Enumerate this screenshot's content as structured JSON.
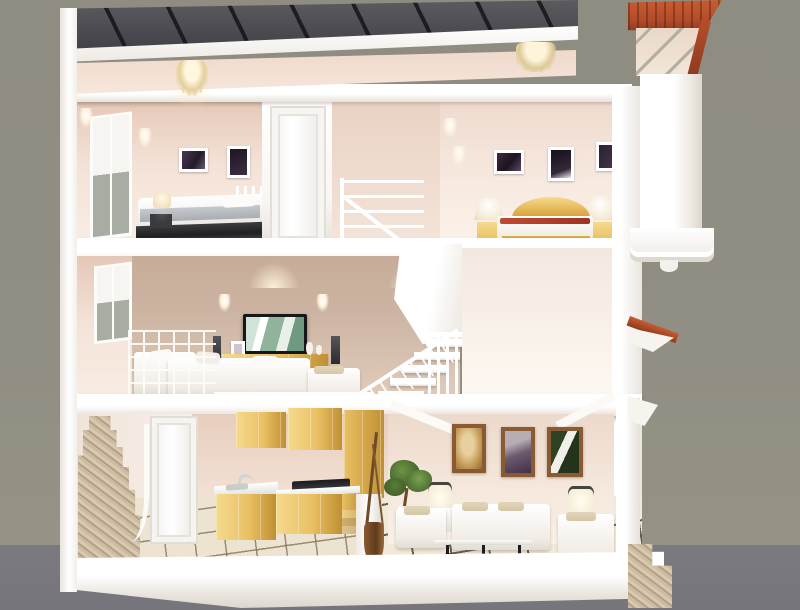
{
  "meta": {
    "description": "3D cutaway cross-section render of a three-story townhouse interior, dollhouse view",
    "style": "photorealistic architectural render, no visible text"
  },
  "palette": {
    "bg": "#918e83",
    "ground": "#76757b",
    "white": "#f8f6f2",
    "whiteDim": "#e6e1da",
    "peach": "#f4e2d7",
    "peachDark": "#e4c7b7",
    "tan": "#ccb3a1",
    "roof": "#4d4d52",
    "roofRib": "#2b2b30",
    "red": "#b44d2a",
    "redDark": "#8e3a1f",
    "wood": "#e9c063",
    "woodL": "#f5da8e",
    "woodD": "#c08f33",
    "frameWood": "#8a5a33",
    "tile": "#ece3d0",
    "stone": "#c3b097",
    "pane": "#a7ada3",
    "dark": "#2a292d",
    "gold": "#dfae49",
    "beige": "#d6c6a8",
    "green": "#5c7d3b",
    "greenDark": "#42602a",
    "brown": "#7a4a28",
    "screen": "#17171b"
  },
  "scene": {
    "backdrop": [
      "studio-gray-wall",
      "dark-gray-ground-plane"
    ],
    "floors": [
      {
        "level": "top",
        "rooms": [
          {
            "name": "master-bedroom-left",
            "items": [
              "corrugated-dark-roof",
              "crystal-chandelier",
              "side-window",
              "wall-sconces-2",
              "framed-photos-2",
              "bedside-lamp",
              "double-bed-white-gray",
              "white-wardrobe-door"
            ]
          },
          {
            "name": "stairwell",
            "items": [
              "white-stair-railing"
            ]
          },
          {
            "name": "bedroom-right",
            "items": [
              "crystal-ceiling-lamp",
              "wall-sconces-2",
              "framed-wedding-photos-3",
              "gold-headboard-bed",
              "red-runner-blanket",
              "nightstands-2",
              "bedside-lamps-2"
            ]
          }
        ]
      },
      {
        "level": "middle",
        "rooms": [
          {
            "name": "family-loft-lounge",
            "items": [
              "side-window",
              "downlights",
              "wall-sconces-2",
              "flat-screen-tv",
              "tv-cabinet-wood",
              "tower-speakers-2",
              "decor-vases",
              "white-corner-sofa",
              "ottoman-chaise",
              "lattice-loft-railing"
            ]
          },
          {
            "name": "stair-hall",
            "items": [
              "white-staircase",
              "baluster-fence",
              "angled-duct-wall"
            ]
          },
          {
            "name": "empty-room-right",
            "items": []
          }
        ]
      },
      {
        "level": "ground",
        "rooms": [
          {
            "name": "kitchen",
            "items": [
              "stone-granite-staircase",
              "curved-white-railing",
              "white-door",
              "upper-cabinets-wood",
              "corner-tall-cabinet",
              "sink-counter-white",
              "faucet",
              "black-cooktop",
              "base-cabinets-wood",
              "drawer-unit",
              "tiled-floor-fine-grid",
              "partition-pillar",
              "floor-vase-with-branches"
            ]
          },
          {
            "name": "living-room",
            "items": [
              "ceiling-beams-white",
              "framed-paintings-3",
              "table-lamp",
              "floor-lamp",
              "potted-plant",
              "armchair-left",
              "three-seat-sofa",
              "armchair-right",
              "glass-coffee-table-black-iron",
              "tiled-floor-bold-grid"
            ]
          }
        ]
      }
    ],
    "exterior": {
      "right-facade": [
        "red-tile-tower-roof",
        "cream-gable-with-truss",
        "white-column",
        "cornice-cap",
        "red-awning-wedge",
        "white-bracket",
        "stone-entry-steps"
      ],
      "base": [
        "white-foundation-slab"
      ]
    }
  }
}
